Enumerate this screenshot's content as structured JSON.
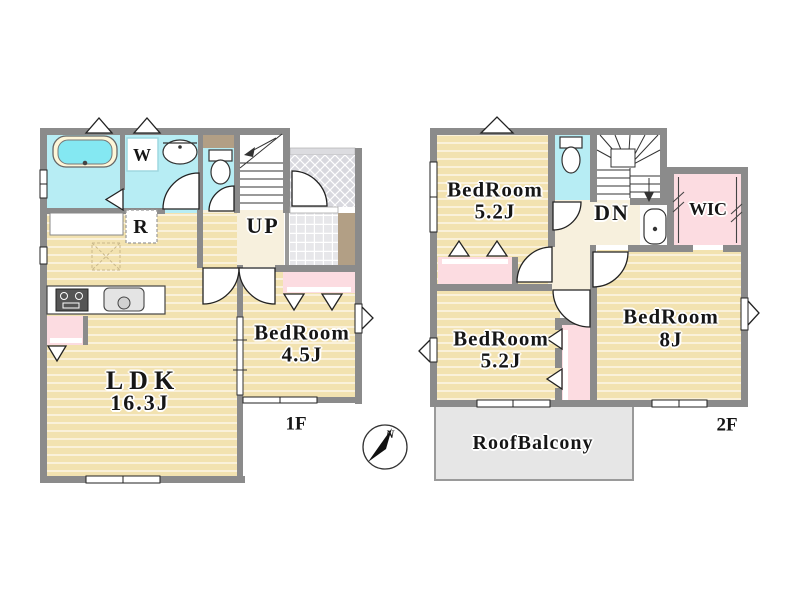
{
  "floor_1": {
    "floor_label": "1F",
    "rooms": {
      "ldk": {
        "name": "LDK",
        "size": "16.3J"
      },
      "bedroom": {
        "name": "BedRoom",
        "size": "4.5J"
      }
    },
    "stairs_label": "UP",
    "washing_machine_label": "W",
    "refrigerator_label": "R"
  },
  "floor_2": {
    "floor_label": "2F",
    "rooms": {
      "bedroom_top": {
        "name": "BedRoom",
        "size": "5.2J"
      },
      "bedroom_left": {
        "name": "BedRoom",
        "size": "5.2J"
      },
      "bedroom_main": {
        "name": "BedRoom",
        "size": "8J"
      },
      "wic": {
        "name": "WIC"
      },
      "roof_balcony": {
        "name": "RoofBalcony"
      }
    },
    "stairs_label": "DN"
  },
  "compass": {
    "north_label": "N"
  },
  "colors": {
    "wall": "#8b8b8b",
    "flooring": "#f2e2b0",
    "wet_area": "#b7edf4",
    "closet": "#fcdce1",
    "hall": "#f7f0dd",
    "balcony": "#e6e6e6",
    "tile_brown": "#b29f85"
  }
}
